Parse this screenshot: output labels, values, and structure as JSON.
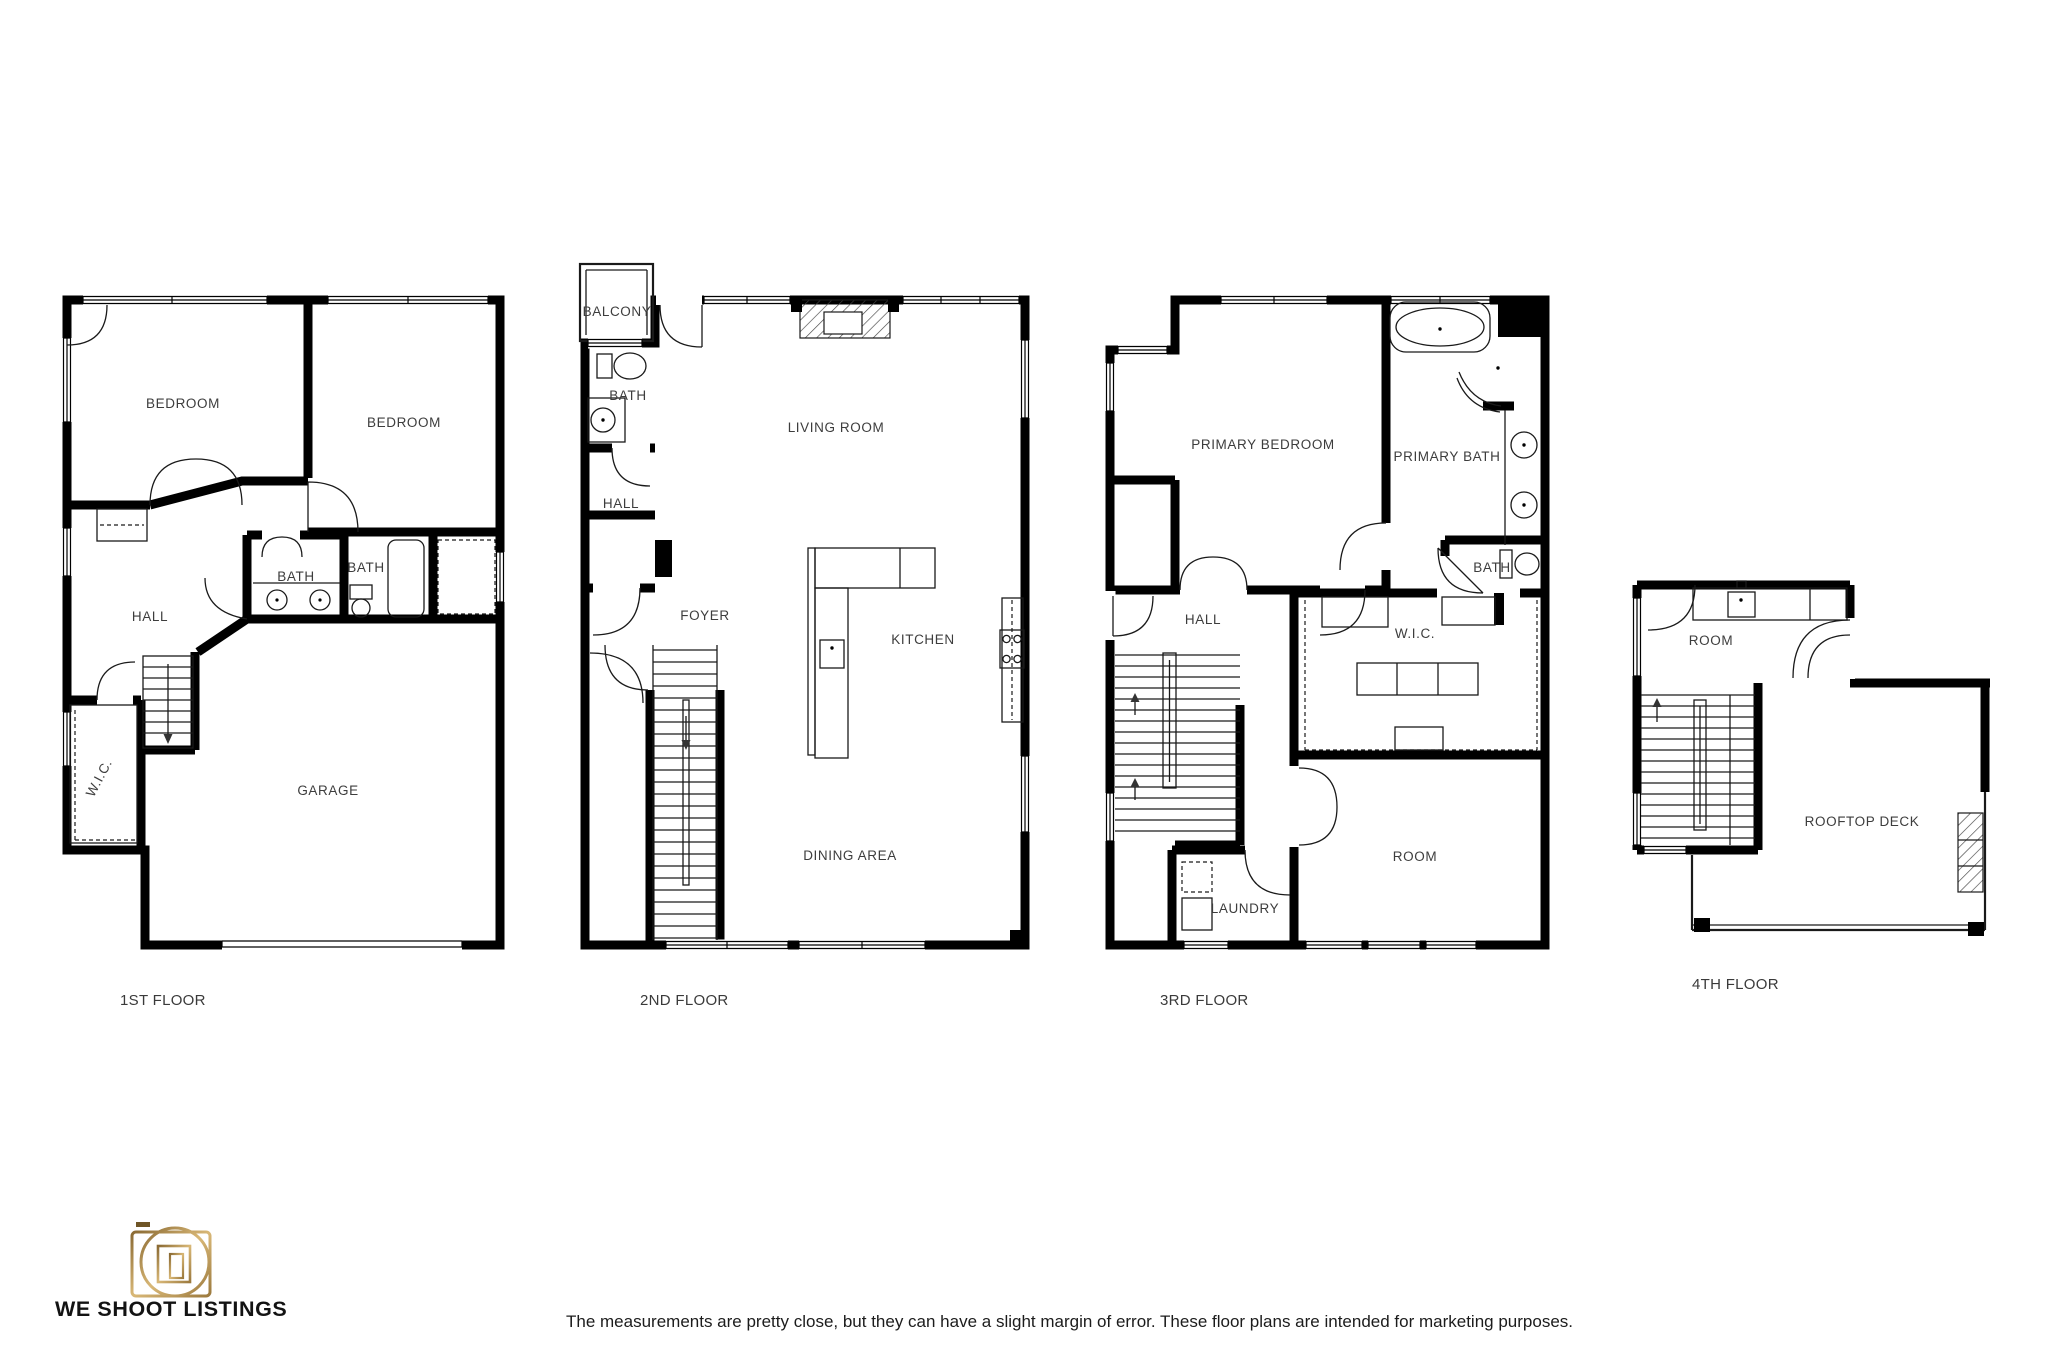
{
  "floors": [
    {
      "caption": "1ST FLOOR",
      "rooms": [
        "BEDROOM",
        "BEDROOM",
        "BATH",
        "BATH",
        "HALL",
        "W.I.C.",
        "GARAGE"
      ]
    },
    {
      "caption": "2ND FLOOR",
      "rooms": [
        "BALCONY",
        "BATH",
        "HALL",
        "LIVING ROOM",
        "FOYER",
        "KITCHEN",
        "DINING AREA"
      ]
    },
    {
      "caption": "3RD FLOOR",
      "rooms": [
        "PRIMARY BEDROOM",
        "PRIMARY BATH",
        "BATH",
        "HALL",
        "W.I.C.",
        "ROOM",
        "LAUNDRY"
      ]
    },
    {
      "caption": "4TH FLOOR",
      "rooms": [
        "ROOM",
        "ROOFTOP DECK"
      ]
    }
  ],
  "footer": {
    "brand": "WE SHOOT LISTINGS",
    "disclaimer": "The measurements are pretty close, but they can have a slight margin of error. These floor plans are intended for marketing purposes."
  },
  "colors": {
    "wall": "#000000",
    "label": "#3d3d3d",
    "gold": "#b9914f"
  }
}
